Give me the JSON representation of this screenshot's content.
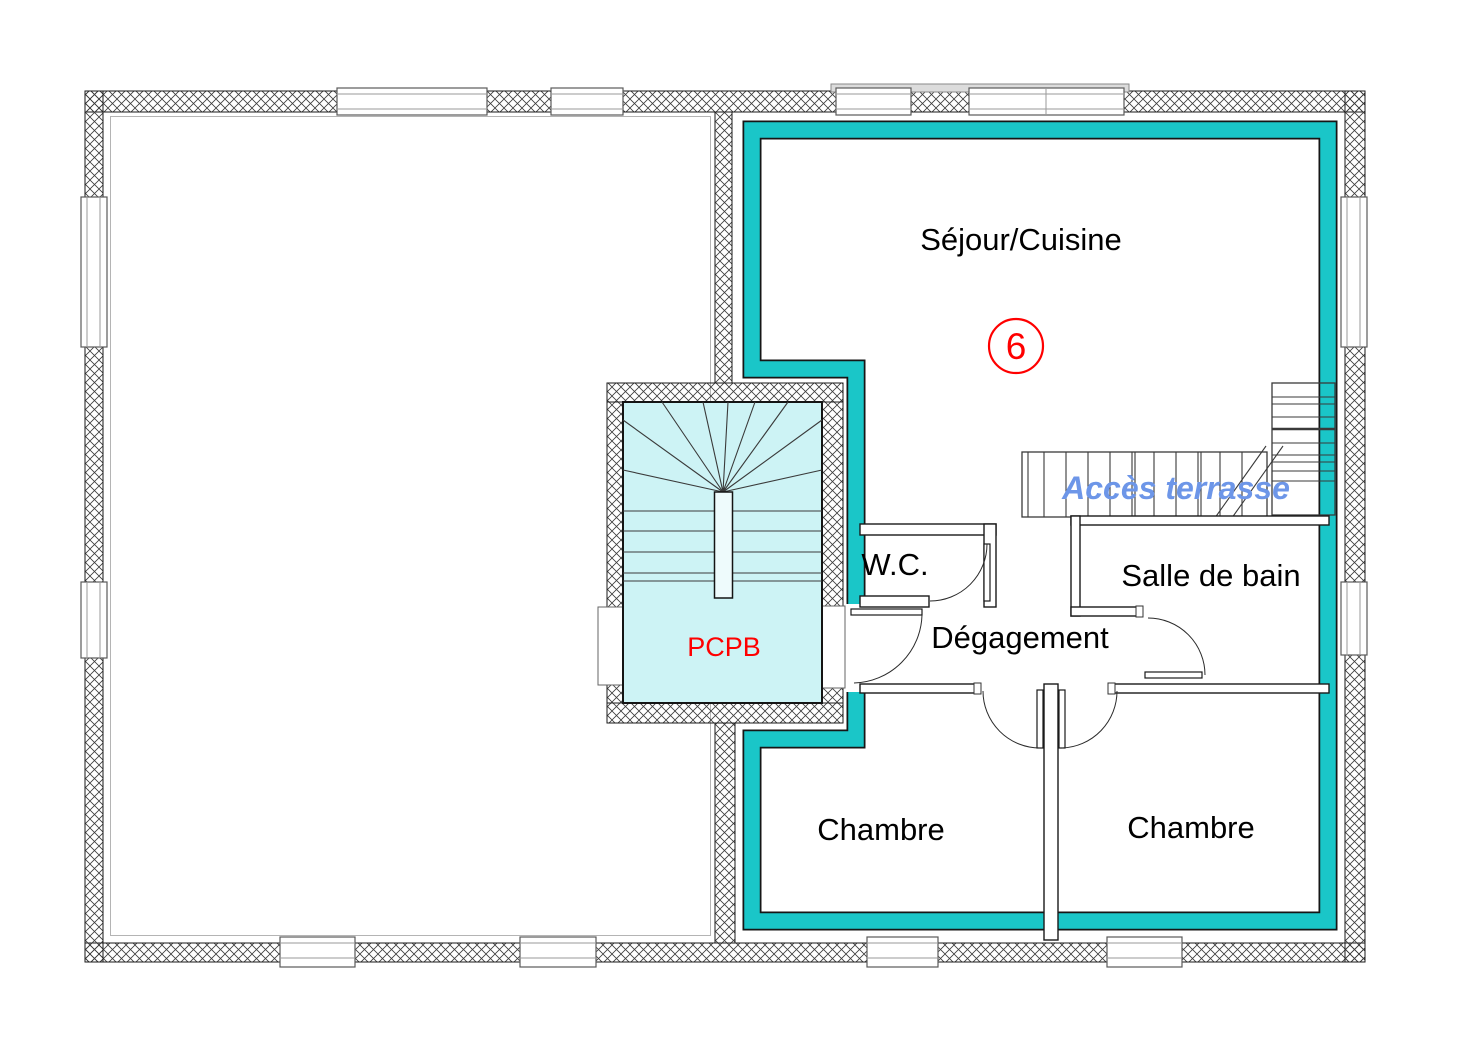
{
  "plan": {
    "title": "floor-plan-unit-6",
    "unit": {
      "number": "6"
    },
    "rooms": [
      {
        "name": "sejour-cuisine",
        "label": "Séjour/Cuisine"
      },
      {
        "name": "wc",
        "label": "W.C."
      },
      {
        "name": "salle-de-bain",
        "label": "Salle de bain"
      },
      {
        "name": "degagement",
        "label": "Dégagement"
      },
      {
        "name": "chambre-1",
        "label": "Chambre"
      },
      {
        "name": "chambre-2",
        "label": "Chambre"
      }
    ],
    "stairwell": {
      "label": "PCPB"
    },
    "terrace": {
      "label": "Accès terrasse"
    },
    "colors": {
      "highlight_teal": "#1ac6c8",
      "stair_fill": "#cdf3f5",
      "unit_red": "#ff0000",
      "terrace_blue": "#6d96e8"
    }
  }
}
